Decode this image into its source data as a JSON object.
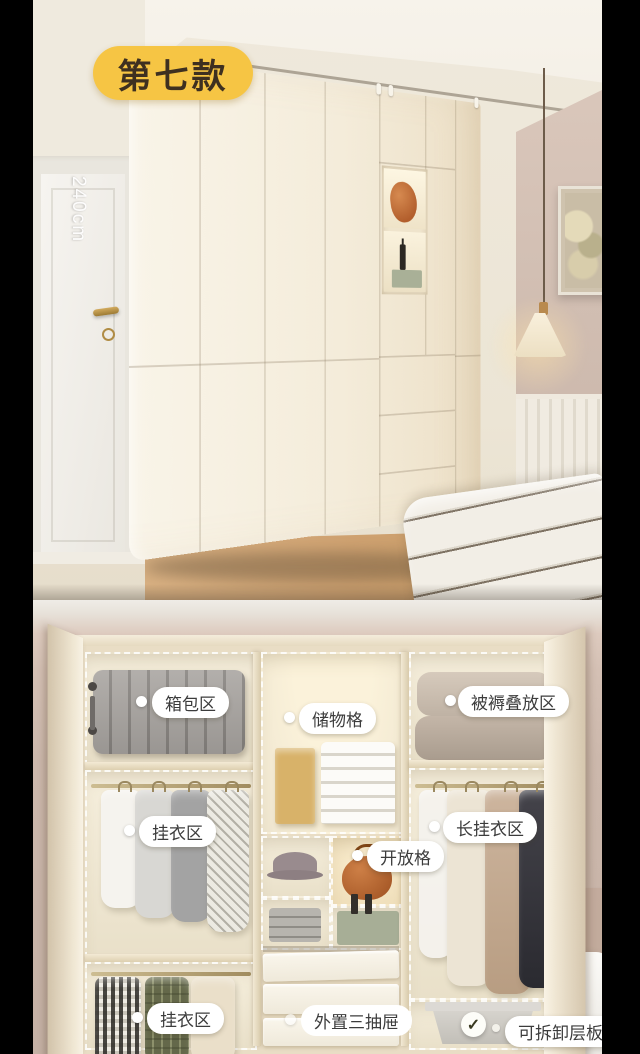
{
  "badge": {
    "text": "第七款"
  },
  "dimension_label": "240cm",
  "zones": {
    "luggage": "箱包区",
    "storage_grid": "储物格",
    "bedding_area": "被褥叠放区",
    "hanging_mid": "挂衣区",
    "open_shelf": "开放格",
    "long_hanging": "长挂衣区",
    "hanging_bottom": "挂衣区",
    "external_drawers": "外置三抽屉",
    "removable_shelf": "可拆卸层板"
  },
  "icons": {
    "check": "✓"
  },
  "colors": {
    "badge_yellow": "#F6C544",
    "badge_text": "#3E3020",
    "label_bg": "#FFFFFF",
    "label_text": "#3C3C3C",
    "wardrobe_cream": "#F3EDDE",
    "wall_pink": "#D5C1B5",
    "floor_wood": "#CFA371"
  }
}
